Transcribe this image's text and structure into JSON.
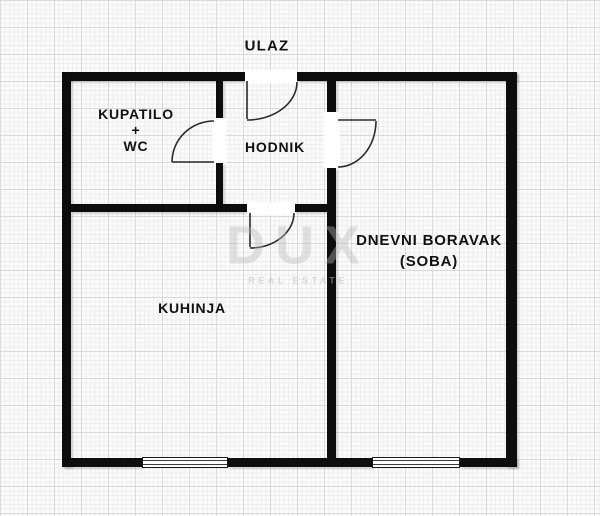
{
  "plan": {
    "labels": {
      "entrance": "ULAZ",
      "bathroom": [
        "KUPATILO",
        "+",
        "WC"
      ],
      "hallway": "HODNIK",
      "living_room": [
        "DNEVNI BORAVAK",
        "(SOBA)"
      ],
      "kitchen": "KUHINJA"
    },
    "watermark": {
      "text": "DUX",
      "subtext": "REAL ESTATE"
    },
    "colors": {
      "wall": "#0d0d0d",
      "paper": "#fbfbfb",
      "grid_fine": "#eeeeee",
      "grid_major": "#d9d9d9",
      "door_line": "#2b2b2b",
      "label_text": "#111111",
      "watermark": "#c9c9c9"
    }
  }
}
